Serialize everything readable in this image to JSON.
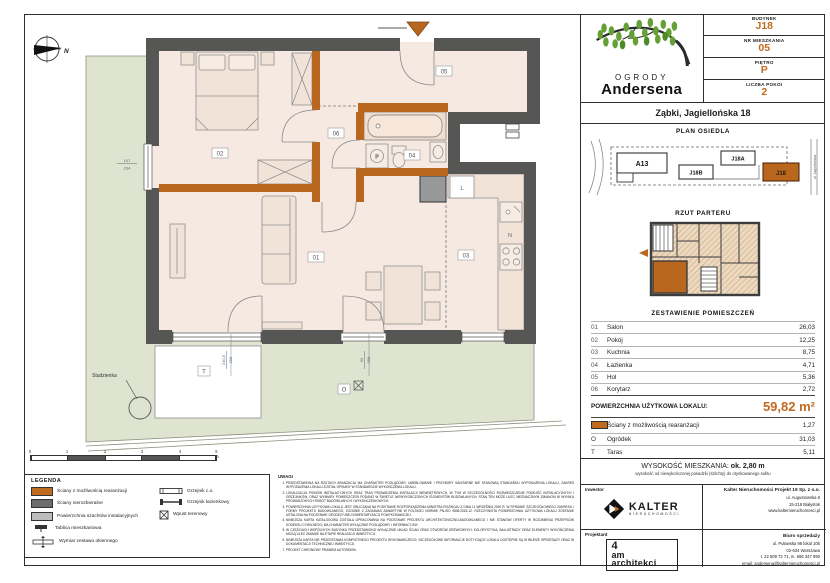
{
  "sheet": {
    "brand": {
      "top": "OGRODY",
      "bottom": "Andersena",
      "address": "Ząbki, Jagiellońska 18"
    },
    "unit_info": [
      {
        "label": "BUDYNEK",
        "value": "J18"
      },
      {
        "label": "NR MIESZKANIA",
        "value": "05"
      },
      {
        "label": "PIĘTRO",
        "value": "P"
      },
      {
        "label": "LICZBA POKOI",
        "value": "2"
      }
    ],
    "site_plan": {
      "title": "PLAN OSIEDLA",
      "buildings": [
        "A13",
        "J18B",
        "J18A",
        "J18"
      ],
      "street": "ul. Jagiellońska"
    },
    "floor_plan_thumb": {
      "title": "RZUT PARTERU"
    },
    "rooms": {
      "title": "ZESTAWIENIE POMIESZCZEŃ",
      "rows": [
        {
          "no": "01",
          "name": "Salon",
          "area": "26,03"
        },
        {
          "no": "02",
          "name": "Pokój",
          "area": "12,25"
        },
        {
          "no": "03",
          "name": "Kuchnia",
          "area": "8,75"
        },
        {
          "no": "04",
          "name": "Łazienka",
          "area": "4,71"
        },
        {
          "no": "05",
          "name": "Hol",
          "area": "5,36"
        },
        {
          "no": "06",
          "name": "Korytarz",
          "area": "2,72"
        }
      ],
      "total_label": "POWIERZCHNIA UŻYTKOWA LOKALU:",
      "total_value": "59,82 m²",
      "extras": [
        {
          "key": "",
          "name": "Ściany z możliwością rearanżacji",
          "area": "1,27"
        },
        {
          "key": "O",
          "name": "Ogródek",
          "area": "31,03"
        },
        {
          "key": "T",
          "name": "Taras",
          "area": "5,11"
        }
      ]
    },
    "height_note": {
      "label": "WYSOKOŚĆ MIESZKANIA:",
      "value": "ok. 2,80 m",
      "sub": "wysokość od niewykończonej posadzki (szlichty) do otynkowanego sufitu"
    },
    "footer": {
      "investor_label": "Inwestor",
      "investor_logo": {
        "name": "KALTER",
        "sub": "NIERUCHOMOŚCI"
      },
      "company_name": "Kalter Nieruchomości Projekt 19 Sp. z o.o.",
      "company_lines": [
        "ul. Augustowska 8",
        "15-218 Białystok",
        "www.kalternieruchomosci.pl"
      ],
      "office_label": "Biuro sprzedaży",
      "office_lines": [
        "ul. Puławska 98 lokal 105",
        "02-634 Warszawa",
        "t. 22 509 72 71, m. 666 347 990",
        "email: andersena@kalternieruchomosci.pl"
      ],
      "designer_label": "Projektant",
      "designer_logo_lines": [
        "4",
        "am",
        "architekci"
      ]
    }
  },
  "legend": {
    "title": "LEGENDA",
    "col1": [
      "Ściany z możliwością rearanżacji",
      "Ściany nierozbieralne",
      "Powierzchnia szachtów instalacyjnych",
      "Tablica mieszkaniowa",
      "Wymiar zestawu okiennego"
    ],
    "col2": [
      "Grzejnik c.o.",
      "Grzejnik łazienkowy",
      "Wpust terenowy"
    ]
  },
  "notes": {
    "title": "UWAGI",
    "items": [
      "PRZEDSTAWIONA NA RZUTACH ARANŻACJA MA CHARAKTER POGLĄDOWY. UMEBLOWANIE I PRZYBORY SANITARNE NIE STANOWIĄ STANDARDU WYPOSAŻENIA LOKALU, ZAKRES WYPOSAŻENIA LOKALU ZOSTAŁ OPISANY W STANDARDZIE WYKOŃCZENIA LOKALU.",
      "LOKALIZACJA PIONÓW INSTALACYJNYCH ORAZ TRAS PROWADZENIA INSTALACJI WEWNĘTRZNYCH, W TYM W SZCZEGÓLNOŚCI ROZMIESZCZENIE PODEJŚĆ INSTALACYJNYCH I GRZEJNIKÓW, ORAZ WYMIARY POMIESZCZEŃ PODANO W ŚWIETLE NIEWYKOŃCZONYCH ELEMENTÓW BUDOWLANYCH; STAN TEN MOŻE ULEC NIEZNACZNYM ZMIANOM W WYNIKU PROWADZONYCH ROBÓT BUDOWLANYCH I WYKOŃCZENIOWYCH.",
      "POWIERZCHNIA UŻYTKOWA LOKALU JEST OBLICZANA NA PODSTAWIE ROZPORZĄDZENIA MINISTRA ROZWOJU Z DNIA 11 WRZEŚNIA 2020 R. W SPRAWIE SZCZEGÓŁOWEGO ZAKRESU I FORMY PROJEKTU BUDOWLANEGO, ZGODNIE Z ZASADAMI ZAWARTYMI W POLSKIEJ NORMIE PN-ISO 9836:2015-12. RZECZYWISTA POWIERZCHNIA UŻYTKOWA LOKALU ZOSTANIE USTALONA NA PODSTAWIE GEODEZYJNEJ INWENTARYZACJI POWYKONAWCZEJ.",
      "NINIEJSZA KARTA KATALOGOWA ZOSTAŁA OPRACOWANA NA PODSTAWIE PROJEKTU ARCHITEKTONICZNO-BUDOWLANEGO I NIE STANOWI OFERTY W ROZUMIENIU PRZEPISÓW KODEKSU CYWILNEGO; MA CHARAKTER WYŁĄCZNIE POGLĄDOWY I INFORMACYJNY.",
      "W CZĘŚCIACH WSPÓLNYCH BUDYNKU PRZEDSTAWIONO WYŁĄCZNIE UKŁAD ŚCIAN ORAZ OTWORÓW DRZWIOWYCH; KOLORYSTYKA, BALUSTRADY ORAZ ELEMENTY WYKOŃCZENIA MOGĄ ULEC ZMIANIE NA ETAPIE REALIZACJI INWESTYCJI.",
      "NINIEJSZA KARTA NIE PRZEDSTAWIA KOMPLETNEGO PROJEKTU WYKONAWCZEGO; SZCZEGÓŁOWE INFORMACJE DOTYCZĄCE LOKALU DOSTĘPNE SĄ W BIURZE SPRZEDAŻY ORAZ W DOKUMENTACJI TECHNICZNEJ INWESTYCJI.",
      "PROJEKT CHRONIONY PRAWEM AUTORSKIM."
    ]
  },
  "plan": {
    "room_labels": {
      "salon": "01",
      "pokoj": "02",
      "kuchnia": "03",
      "lazienka": "04",
      "hol": "05",
      "korytarz": "06"
    },
    "markers": {
      "terrace": "T",
      "garden": "O",
      "north": "N",
      "well": "Studzienka",
      "fridge": "L",
      "niche": "N",
      "washer": "P"
    },
    "dims": {
      "left_w": "107",
      "left_h": "234",
      "terrace_w": "240,5",
      "terrace_h": "258",
      "door_w": "90",
      "door_h": "258"
    }
  },
  "scalebar": {
    "labels": [
      "0",
      "1",
      "2",
      "3",
      "4",
      "5 m"
    ]
  },
  "colors": {
    "accent": "#C06A1F",
    "wall": "#565655",
    "orange_wall": "#B9671E",
    "garden": "#DFE4D0",
    "room": "#F5E9E1"
  }
}
